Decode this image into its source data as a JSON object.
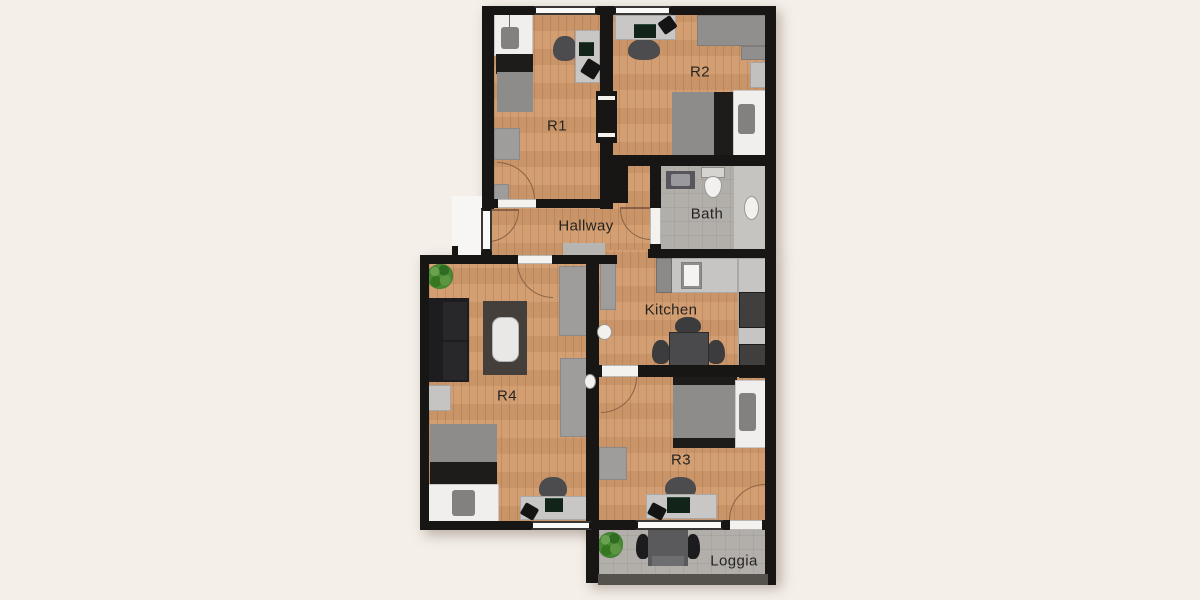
{
  "rooms": [
    {
      "id": "r1",
      "label": "R1"
    },
    {
      "id": "r2",
      "label": "R2"
    },
    {
      "id": "bath",
      "label": "Bath"
    },
    {
      "id": "hallway",
      "label": "Hallway"
    },
    {
      "id": "kitchen",
      "label": "Kitchen"
    },
    {
      "id": "r4",
      "label": "R4"
    },
    {
      "id": "r3",
      "label": "R3"
    },
    {
      "id": "loggia",
      "label": "Loggia"
    }
  ],
  "colors": {
    "background": "#f4efe9",
    "wall": "#171614",
    "wood_floor": "#d09a6c",
    "tile_floor": "#b2afab",
    "label_text": "#262422",
    "door_arc": "#8a6144"
  }
}
